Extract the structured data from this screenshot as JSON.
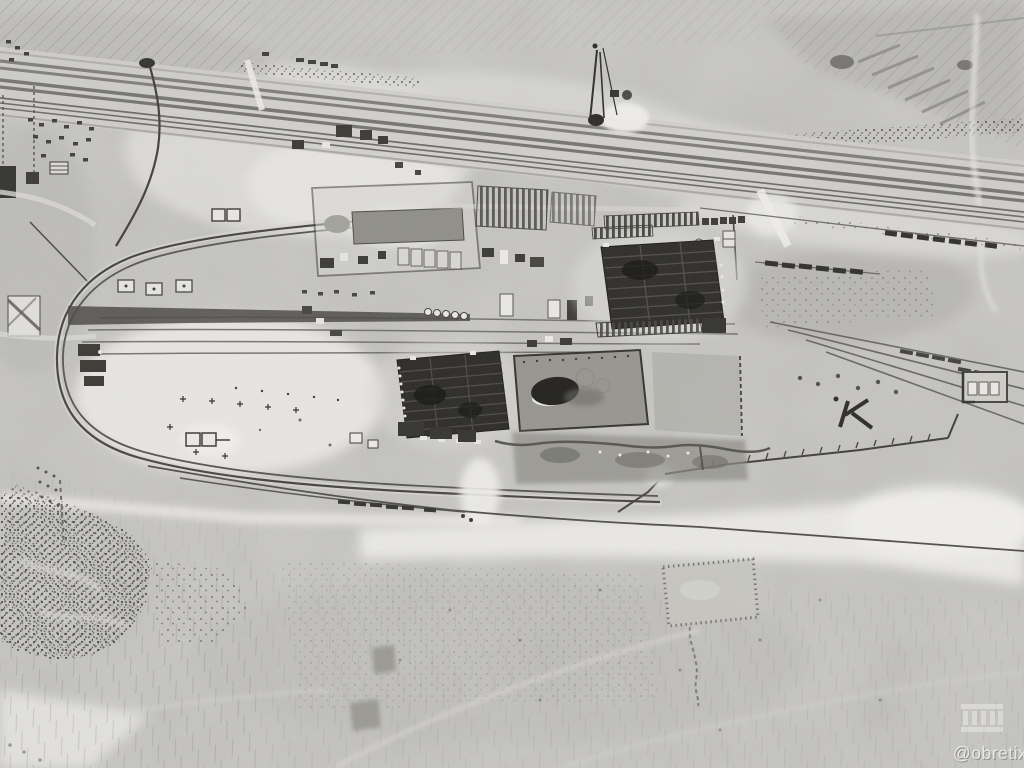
{
  "image": {
    "type": "grayscale satellite photograph",
    "subject": "desert industrial construction site and rail yard beside a divided highway",
    "palette": {
      "desert_base": "#c6c5c2",
      "bright_sand": "#ecebe7",
      "road_stripe": "#7d7c79",
      "dark_structure": "#2b2a27",
      "walled_yard_gray": "#96958e",
      "vegetation_dark": "#4b4a44"
    }
  },
  "watermark": {
    "handle": "@obretix",
    "icon": "monument-icon"
  },
  "features": [
    {
      "name": "highway-corridor",
      "label": "divided highway with parallel railway"
    },
    {
      "name": "construction-crane",
      "label": "crane rig beside the highway"
    },
    {
      "name": "rail-loop",
      "label": "rail loop around west end of facility"
    },
    {
      "name": "rail-yard",
      "label": "parallel yard tracks"
    },
    {
      "name": "steel-frame-building-west",
      "label": "large steel-frame building under construction"
    },
    {
      "name": "walled-yard-dome",
      "label": "domed structure inside walled yard"
    },
    {
      "name": "steel-frame-building-east",
      "label": "large steel-frame building under construction"
    },
    {
      "name": "storage-compound",
      "label": "fenced compound with long shed"
    },
    {
      "name": "vegetation-patch",
      "label": "scrub vegetation patch"
    },
    {
      "name": "field-plot",
      "label": "hedged rectangular plot"
    },
    {
      "name": "cleared-squares",
      "label": "two graded square pads"
    },
    {
      "name": "desert-terrain",
      "label": "graded desert ground with track marks"
    }
  ]
}
